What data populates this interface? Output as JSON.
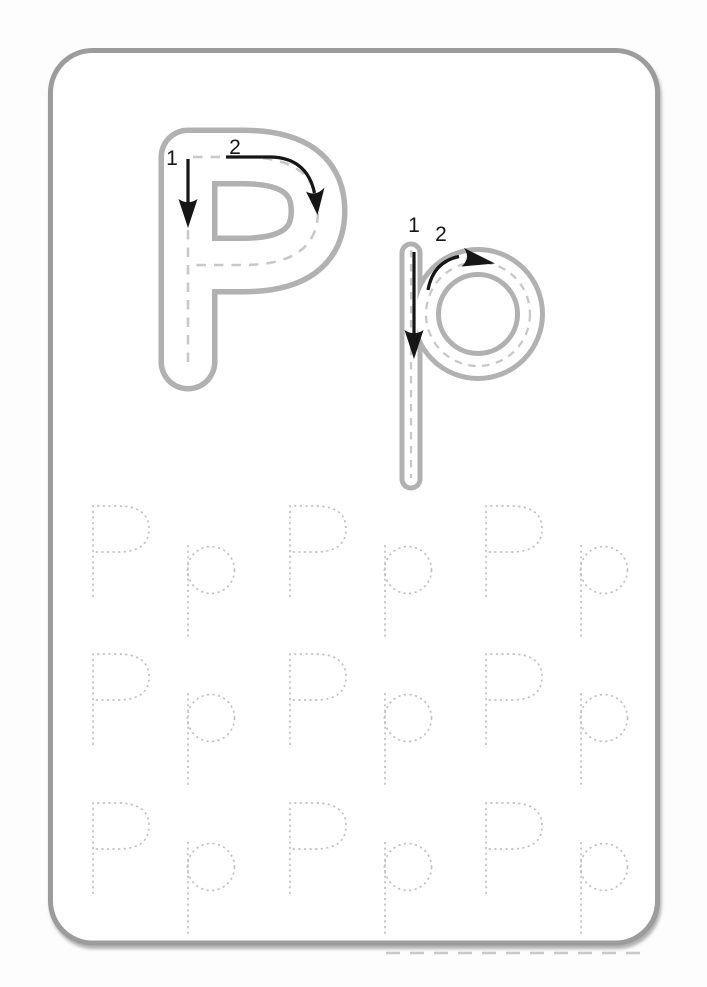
{
  "worksheet": {
    "title_letter": "P",
    "guide": {
      "uppercase": {
        "letter": "P",
        "stroke1_label": "1",
        "stroke2_label": "2"
      },
      "lowercase": {
        "letter": "p",
        "stroke1_label": "1",
        "stroke2_label": "2"
      }
    },
    "trace_rows": [
      {
        "letters": [
          "P",
          "p",
          "P",
          "p",
          "P",
          "p"
        ]
      },
      {
        "letters": [
          "P",
          "p",
          "P",
          "p",
          "P",
          "p"
        ]
      },
      {
        "letters": [
          "P",
          "p",
          "P",
          "p",
          "P",
          "p"
        ]
      }
    ],
    "colors": {
      "page_background": "#fdfdfd",
      "card_border": "#9c9c9c",
      "letter_outline": "#b1b1b1",
      "letter_fill": "#ffffff",
      "trace_dash": "#c8c8c8",
      "dotted_letter": "#c2c2c2",
      "arrow_black": "#161616"
    }
  }
}
